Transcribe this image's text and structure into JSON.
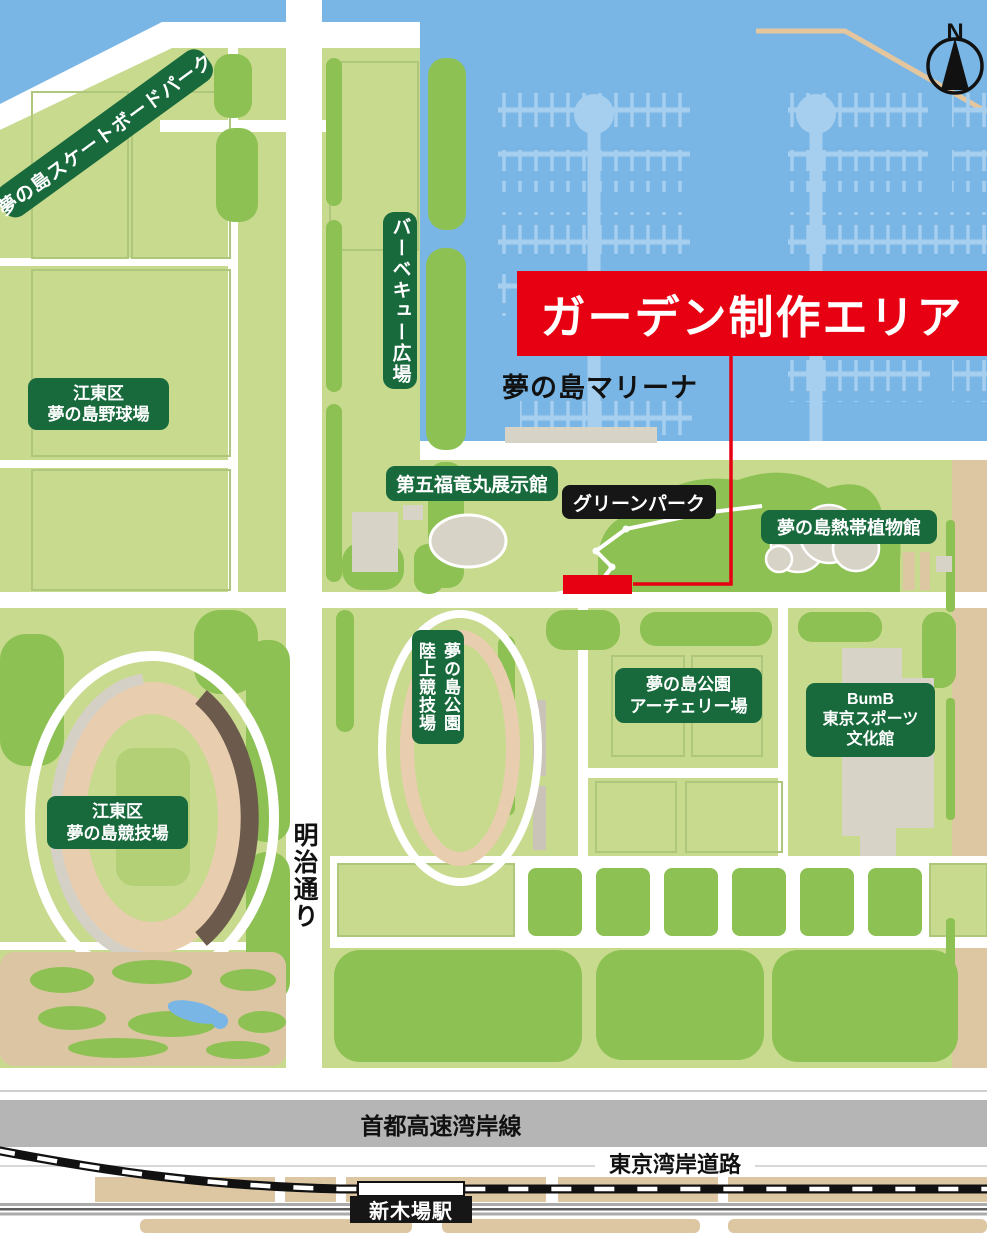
{
  "colors": {
    "accent_red": "#E60012",
    "banner_green": "#186A3D",
    "banner_black": "#161616",
    "water_blue": "#79B6E5",
    "dock_blue": "#A6CFEF",
    "land_green": "#C8DA8E",
    "dark_green": "#8DC153",
    "path_tan": "#DDC6A2",
    "track_tan": "#E9CDAF",
    "building_gray": "#D8D3C7",
    "grandstand_brown": "#6C5A4C",
    "expressway_gray": "#B5B5B5"
  },
  "banners": {
    "skatepark": "夢の島スケートボードパーク",
    "bbq_plaza": "バーベキュー広場",
    "garden_area": "ガーデン制作エリア",
    "marina": "夢の島マリーナ",
    "daigo_fukuryumaru": "第五福竜丸展示館",
    "green_park": "グリーンパーク",
    "botanical_dome": "夢の島熱帯植物館",
    "baseball": {
      "line1": "江東区",
      "line2": "夢の島野球場"
    },
    "athletics": {
      "line1": "夢の島公園",
      "line2": "陸上競技場"
    },
    "archery": {
      "line1": "夢の島公園",
      "line2": "アーチェリー場"
    },
    "bumb": {
      "line1": "BumB",
      "line2": "東京スポーツ",
      "line3": "文化館"
    },
    "stadium": {
      "line1": "江東区",
      "line2": "夢の島競技場"
    }
  },
  "roads": {
    "meiji_street": "明治通り",
    "expressway": "首都高速湾岸線",
    "bay_road": "東京湾岸道路"
  },
  "station": {
    "name": "新木場駅"
  },
  "compass": {
    "north": "N"
  }
}
